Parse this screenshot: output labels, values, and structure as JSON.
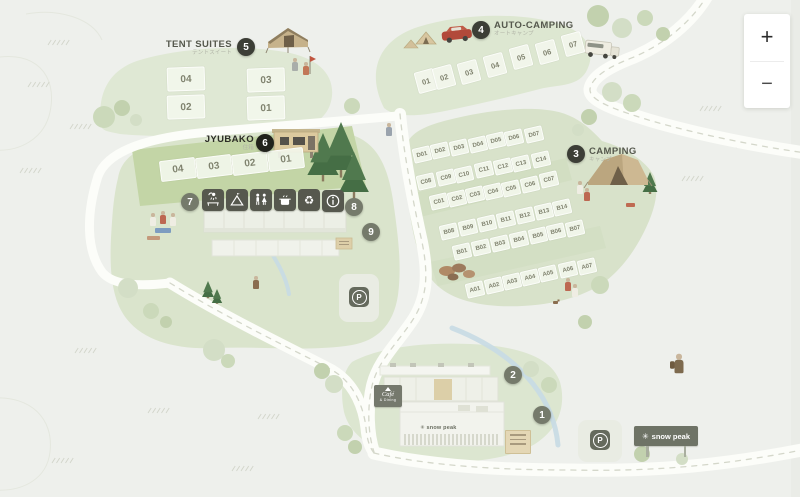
{
  "colors": {
    "background": "#eef0ec",
    "area_green": "#dfe8d4",
    "band_green": "#c3d5a6",
    "road": "#fcfdf9",
    "marker_dark": "#3c3e36",
    "marker_gray": "#757a6b",
    "marker_black": "#21221c",
    "stream_blue": "#c6dae4"
  },
  "zoom_control": {
    "zoom_in": "+",
    "zoom_out": "−"
  },
  "labels": {
    "tent_suites": {
      "title": "TENT SUITES",
      "subtitle": "テントスイート"
    },
    "auto_camping": {
      "title": "AUTO-CAMPING",
      "subtitle": "オートキャンプ"
    },
    "camping": {
      "title": "CAMPING",
      "subtitle": "キャンプ"
    },
    "jyubako": {
      "title": "JYUBAKO",
      "subtitle": "住箱"
    }
  },
  "signs": {
    "cafe": {
      "line1": "Café",
      "line2": "& Dining"
    },
    "billboard_text": "snow peak",
    "store_logo_text": "snow peak",
    "parking_letter": "P"
  },
  "markers": [
    {
      "n": "1",
      "x": 542,
      "y": 415,
      "tone": "gray"
    },
    {
      "n": "2",
      "x": 513,
      "y": 375,
      "tone": "gray"
    },
    {
      "n": "3",
      "x": 576,
      "y": 154,
      "tone": "dark"
    },
    {
      "n": "4",
      "x": 481,
      "y": 30,
      "tone": "dark"
    },
    {
      "n": "5",
      "x": 246,
      "y": 47,
      "tone": "dark"
    },
    {
      "n": "6",
      "x": 265,
      "y": 143,
      "tone": "black"
    },
    {
      "n": "7",
      "x": 190,
      "y": 202,
      "tone": "gray"
    },
    {
      "n": "8",
      "x": 354,
      "y": 207,
      "tone": "gray"
    },
    {
      "n": "9",
      "x": 371,
      "y": 232,
      "tone": "gray"
    }
  ],
  "amenities": [
    {
      "name": "shower-icon",
      "x": 213,
      "y": 200
    },
    {
      "name": "house-icon",
      "x": 237,
      "y": 200
    },
    {
      "name": "restroom-icon",
      "x": 261,
      "y": 200
    },
    {
      "name": "kitchen-icon",
      "x": 285,
      "y": 200
    },
    {
      "name": "recycle-icon",
      "x": 309,
      "y": 200
    },
    {
      "name": "info-icon",
      "x": 333,
      "y": 201
    }
  ],
  "site_groups": [
    {
      "name": "tent-suites",
      "rot": -2,
      "w": 36,
      "h": 22,
      "font": 10,
      "sites": [
        {
          "label": "04",
          "x": 185,
          "y": 78
        },
        {
          "label": "03",
          "x": 265,
          "y": 79
        },
        {
          "label": "02",
          "x": 185,
          "y": 106
        },
        {
          "label": "01",
          "x": 265,
          "y": 107
        }
      ]
    },
    {
      "name": "jyubako",
      "rot": -7,
      "w": 34,
      "h": 19,
      "font": 10,
      "sites": [
        {
          "label": "04",
          "x": 177,
          "y": 168
        },
        {
          "label": "03",
          "x": 213,
          "y": 165
        },
        {
          "label": "02",
          "x": 249,
          "y": 162
        },
        {
          "label": "01",
          "x": 285,
          "y": 158
        }
      ]
    },
    {
      "name": "auto-camping",
      "rot": -15,
      "w": 18,
      "h": 20,
      "font": 7.5,
      "sites": [
        {
          "label": "01",
          "x": 425,
          "y": 80
        },
        {
          "label": "02",
          "x": 443,
          "y": 76
        },
        {
          "label": "03",
          "x": 468,
          "y": 71
        },
        {
          "label": "04",
          "x": 494,
          "y": 64
        },
        {
          "label": "05",
          "x": 520,
          "y": 56
        },
        {
          "label": "06",
          "x": 546,
          "y": 51
        },
        {
          "label": "07",
          "x": 572,
          "y": 43
        }
      ]
    },
    {
      "name": "camping-d",
      "rot": -13,
      "w": 16,
      "h": 13,
      "font": 6,
      "sites": [
        {
          "label": "D01",
          "x": 421,
          "y": 153
        },
        {
          "label": "D02",
          "x": 439,
          "y": 149
        },
        {
          "label": "D03",
          "x": 458,
          "y": 146
        },
        {
          "label": "D04",
          "x": 477,
          "y": 143
        },
        {
          "label": "D05",
          "x": 495,
          "y": 139
        },
        {
          "label": "D06",
          "x": 513,
          "y": 136
        },
        {
          "label": "D07",
          "x": 533,
          "y": 133
        }
      ]
    },
    {
      "name": "camping-c-upper",
      "rot": -13,
      "w": 16,
      "h": 13,
      "font": 6,
      "sites": [
        {
          "label": "C08",
          "x": 425,
          "y": 180
        },
        {
          "label": "C09",
          "x": 445,
          "y": 176
        },
        {
          "label": "C10",
          "x": 463,
          "y": 173
        },
        {
          "label": "C11",
          "x": 483,
          "y": 168
        },
        {
          "label": "C12",
          "x": 502,
          "y": 165
        },
        {
          "label": "C13",
          "x": 520,
          "y": 162
        },
        {
          "label": "C14",
          "x": 540,
          "y": 158
        }
      ]
    },
    {
      "name": "camping-c-lower",
      "rot": -13,
      "w": 16,
      "h": 13,
      "font": 6,
      "sites": [
        {
          "label": "C01",
          "x": 438,
          "y": 200
        },
        {
          "label": "C02",
          "x": 456,
          "y": 197
        },
        {
          "label": "C03",
          "x": 474,
          "y": 193
        },
        {
          "label": "C04",
          "x": 492,
          "y": 190
        },
        {
          "label": "C05",
          "x": 510,
          "y": 187
        },
        {
          "label": "C06",
          "x": 529,
          "y": 183
        },
        {
          "label": "C07",
          "x": 548,
          "y": 178
        }
      ]
    },
    {
      "name": "camping-b-upper",
      "rot": -13,
      "w": 16,
      "h": 13,
      "font": 6,
      "sites": [
        {
          "label": "B08",
          "x": 448,
          "y": 230
        },
        {
          "label": "B09",
          "x": 467,
          "y": 226
        },
        {
          "label": "B10",
          "x": 486,
          "y": 222
        },
        {
          "label": "B11",
          "x": 505,
          "y": 218
        },
        {
          "label": "B12",
          "x": 524,
          "y": 214
        },
        {
          "label": "B13",
          "x": 543,
          "y": 210
        },
        {
          "label": "B14",
          "x": 561,
          "y": 206
        }
      ]
    },
    {
      "name": "camping-b-lower",
      "rot": -13,
      "w": 16,
      "h": 13,
      "font": 6,
      "sites": [
        {
          "label": "B01",
          "x": 461,
          "y": 250
        },
        {
          "label": "B02",
          "x": 480,
          "y": 246
        },
        {
          "label": "B03",
          "x": 499,
          "y": 242
        },
        {
          "label": "B04",
          "x": 518,
          "y": 238
        },
        {
          "label": "B05",
          "x": 537,
          "y": 234
        },
        {
          "label": "B06",
          "x": 555,
          "y": 230
        },
        {
          "label": "B07",
          "x": 574,
          "y": 227
        }
      ]
    },
    {
      "name": "camping-a",
      "rot": -13,
      "w": 16,
      "h": 13,
      "font": 6,
      "sites": [
        {
          "label": "A01",
          "x": 474,
          "y": 288
        },
        {
          "label": "A02",
          "x": 493,
          "y": 284
        },
        {
          "label": "A03",
          "x": 511,
          "y": 280
        },
        {
          "label": "A04",
          "x": 529,
          "y": 276
        },
        {
          "label": "A05",
          "x": 547,
          "y": 272
        },
        {
          "label": "A06",
          "x": 567,
          "y": 268
        },
        {
          "label": "A07",
          "x": 586,
          "y": 265
        }
      ]
    }
  ]
}
